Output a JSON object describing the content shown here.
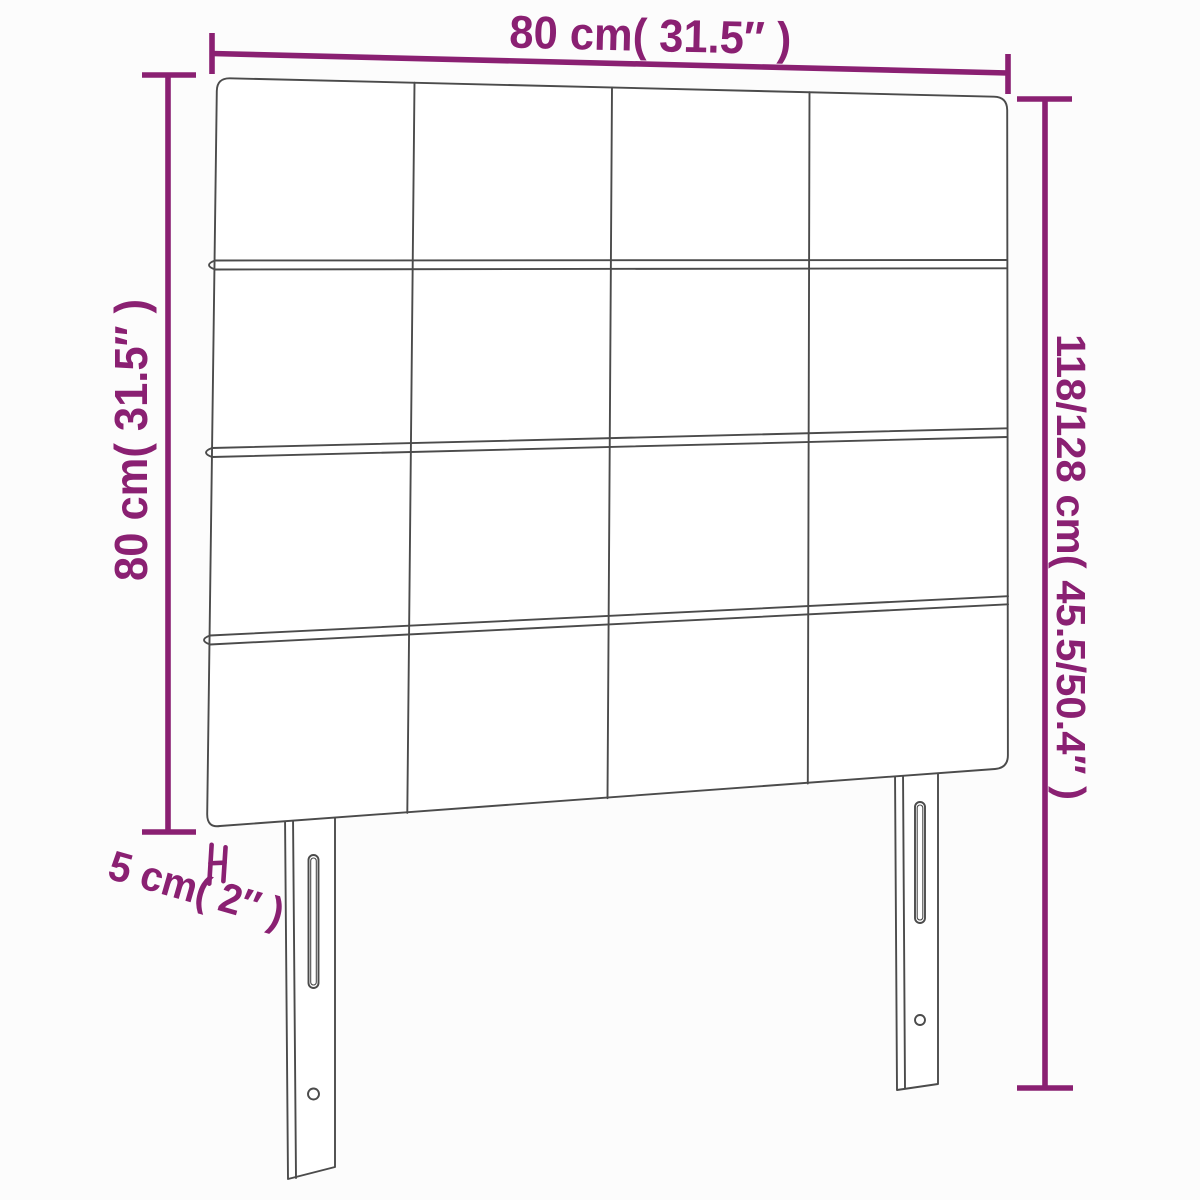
{
  "diagram": {
    "accent_color": "#8a2072",
    "line_color": "#4b4b4b",
    "background": "#fcfcfc",
    "dimensions": {
      "top_width": "80 cm( 31.5″ )",
      "left_height": "80 cm( 31.5″ )",
      "right_total_height": "118/128 cm( 45.5/50.4″ )",
      "bottom_depth": "5 cm( 2″ )"
    },
    "figure": {
      "panel_rows": 4,
      "panel_columns": 4,
      "legs": 2
    }
  }
}
